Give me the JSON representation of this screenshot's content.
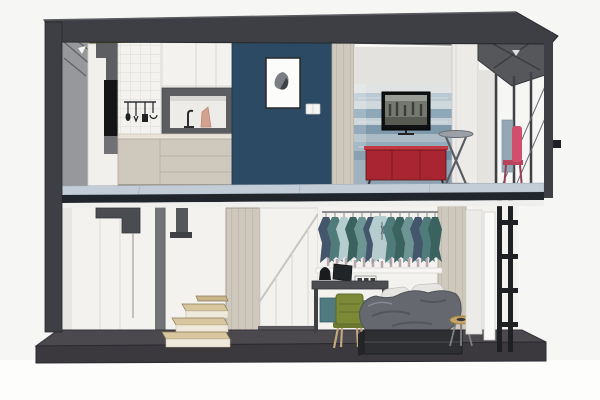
{
  "scene": {
    "type": "3d-cutaway-section-render",
    "floors": [
      {
        "level": "upper",
        "areas": [
          "kitchen",
          "feature-wall",
          "living-area",
          "balcony"
        ]
      },
      {
        "level": "lower",
        "areas": [
          "staircase",
          "understair-storage",
          "bedroom",
          "exterior-ladder"
        ]
      }
    ],
    "objects": [
      "roof-slab",
      "left-wall",
      "right-corner-post",
      "mid-floor-slab",
      "ground-slab",
      "kitchen-upper-cabinets",
      "kitchen-lower-cabinets",
      "tile-backsplash",
      "utensil-rail",
      "faucet",
      "picture-frame",
      "light-switch",
      "tv",
      "mural-wall",
      "red-credenza",
      "bistro-table",
      "pink-chair",
      "balcony-door",
      "railing-posts",
      "winder-stairs",
      "stair-column",
      "understair-cabinets",
      "clothes-rack",
      "desk",
      "laptop",
      "desk-lamp",
      "outlet-strip",
      "green-chair",
      "bed",
      "pillows",
      "blanket",
      "side-stool",
      "ladder-frame"
    ]
  },
  "palette": {
    "bg": "#f6f6f4",
    "structure_dark": "#3d3f44",
    "structure_gray": "#97989b",
    "steel": "#55575b",
    "olive": "#7c8020",
    "navy_wall": "#2c4a63",
    "white_surface": "#f3f2ef",
    "panel_white": "#ecebe8",
    "cabinet_greige": "#cfc8bd",
    "wood_stairs": "#d8c69f",
    "slab_top": "#c3cdd7",
    "slab_dark": "#21262d",
    "floor_dark": "#4b484e",
    "mural_blue": "#8ea8b8",
    "tv_black": "#101113",
    "sofa_red": "#a82531",
    "chair_pink": "#d14f6c",
    "chair_green": "#7c8a38",
    "clothes_teal": "#4f7b7a",
    "clothes_slate": "#44566b",
    "clothes_light": "#b6cdd0",
    "bed_base": "#2d2f33",
    "blanket_gray": "#65686e",
    "pillow_white": "#e7e5e1",
    "stool_tan": "#c8a368",
    "ladder_black": "#1e2023",
    "accent_bluegray": "#93a7b4"
  }
}
